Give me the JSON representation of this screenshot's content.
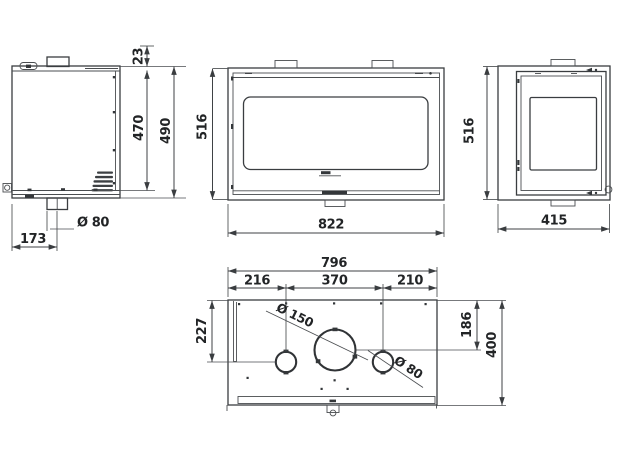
{
  "drawing": {
    "kind": "fireplace insert dimensional drawing",
    "background": "#ffffff",
    "line_color": "#3a3d40",
    "text_color": "#222426"
  },
  "views": {
    "side_left": {
      "label": "left-side-view",
      "dims": {
        "top_collar_height": "23",
        "body_height": "470",
        "overall_height": "490",
        "flue_offset": "173",
        "flue_diameter": "Ø 80"
      }
    },
    "front": {
      "label": "front-view",
      "dims": {
        "height": "516",
        "width": "822"
      }
    },
    "side_right": {
      "label": "right-side-view",
      "dims": {
        "height": "516",
        "depth": "415"
      }
    },
    "top": {
      "label": "top-view",
      "dims": {
        "overall_width": "796",
        "left_offset": "216",
        "center_spacing": "370",
        "right_offset": "210",
        "left_depth": "227",
        "flue_depth": "186",
        "overall_depth": "400",
        "flue_diameter": "Ø 150",
        "outlet_diameter": "Ø 80"
      }
    }
  }
}
